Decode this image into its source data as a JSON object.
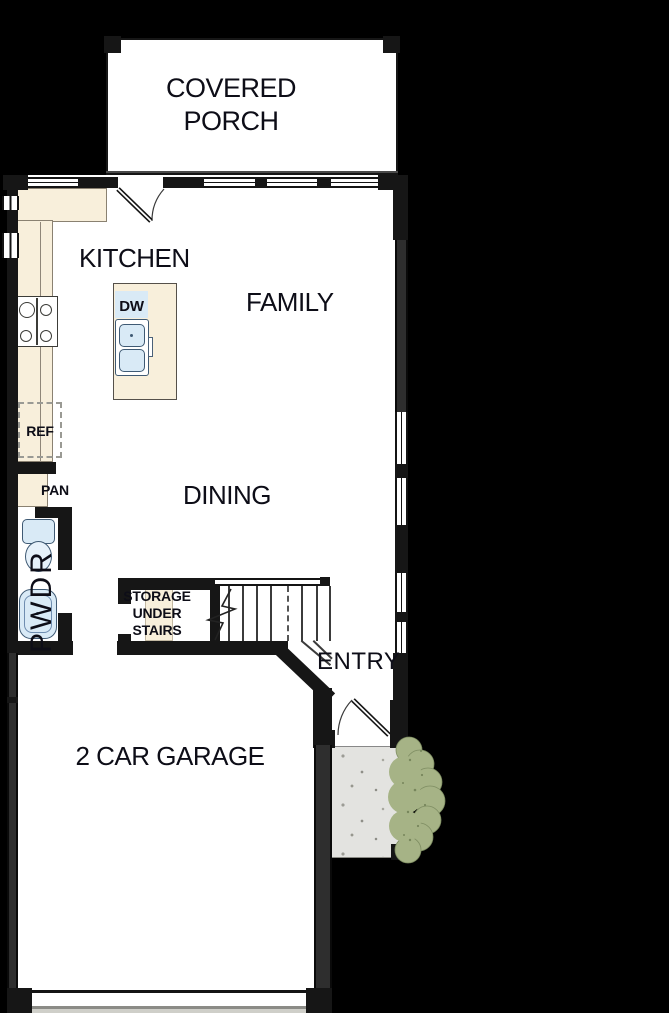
{
  "plan": {
    "rooms": {
      "covered_porch": {
        "label": "COVERED PORCH"
      },
      "kitchen": {
        "label": "KITCHEN"
      },
      "family": {
        "label": "FAMILY"
      },
      "dining": {
        "label": "DINING"
      },
      "entry": {
        "label": "ENTRY"
      },
      "garage": {
        "label": "2 CAR GARAGE"
      },
      "powder_room": {
        "label": "PWDR"
      },
      "storage": {
        "label": "STORAGE UNDER STAIRS"
      }
    },
    "fixtures": {
      "dishwasher": {
        "label": "DW"
      },
      "refrigerator": {
        "label": "REF"
      },
      "pantry": {
        "label": "PAN"
      }
    },
    "colors": {
      "background": "#000000",
      "floor": "#ffffff",
      "wall": "#161616",
      "counter": "#f8efdb",
      "fixture_blue": "#d9eaf6",
      "stoop": "#e3e3e0",
      "bush": "#a6b386",
      "label_text": "#0d0d17"
    }
  }
}
